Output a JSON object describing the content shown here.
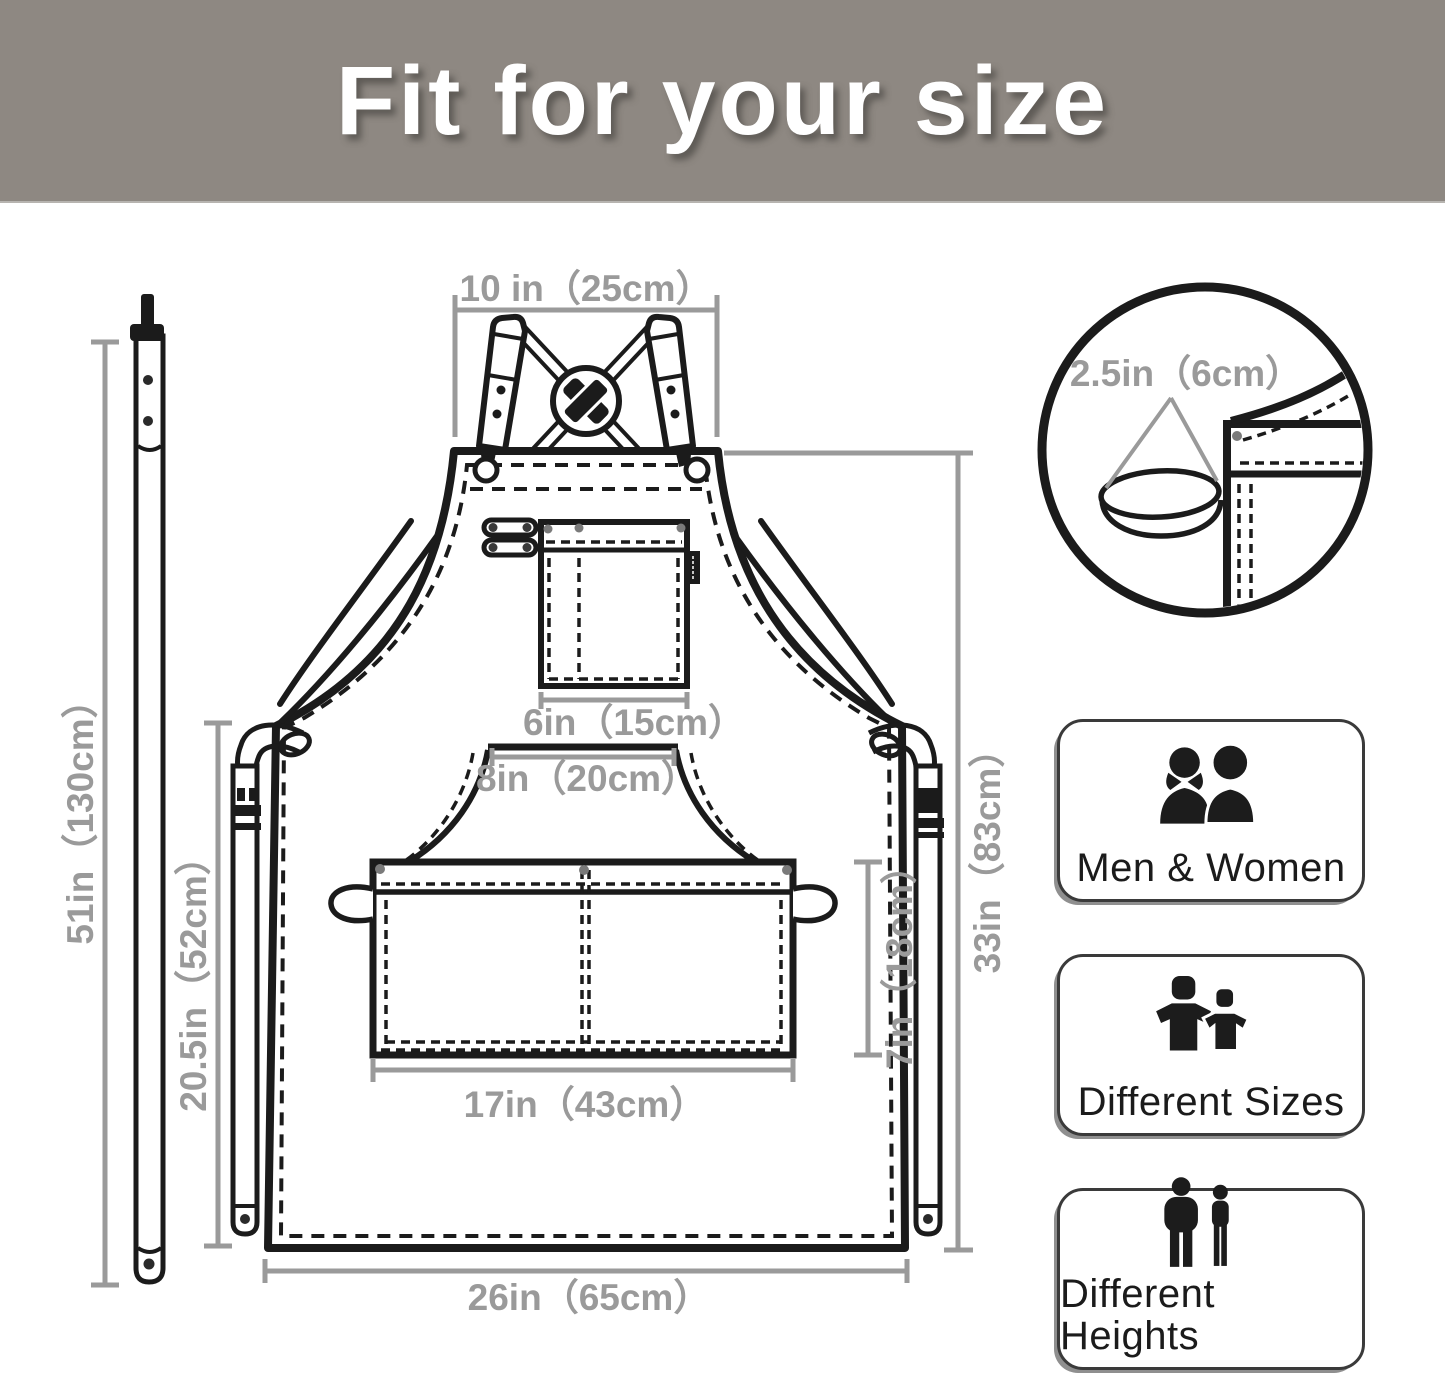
{
  "header": {
    "title": "Fit for your size"
  },
  "apron_diagram": {
    "dimensions": {
      "neck_strap_length": "51in（130cm）",
      "bib_top_width": "10 in（25cm）",
      "chest_pocket_width": "6in（15cm）",
      "waist_pocket_top_width": "8in（20cm）",
      "side_length": "20.5in（52cm）",
      "waist_pocket_width": "17in（43cm）",
      "waist_pocket_height": "7in（18cm）",
      "body_length": "33in（83cm）",
      "bottom_width": "26in（65cm）"
    },
    "inset": {
      "loop_width": "2.5in（6cm）"
    }
  },
  "features": [
    {
      "icon": "men-women-icon",
      "label": "Men & Women"
    },
    {
      "icon": "different-sizes-icon",
      "label": "Different Sizes"
    },
    {
      "icon": "different-heights-icon",
      "label": "Different Heights"
    }
  ],
  "colors": {
    "banner_background": "#8e8882",
    "banner_text": "#ffffff",
    "dimension_annotation": "#9a9a9a",
    "line_art": "#1b1b1b"
  }
}
